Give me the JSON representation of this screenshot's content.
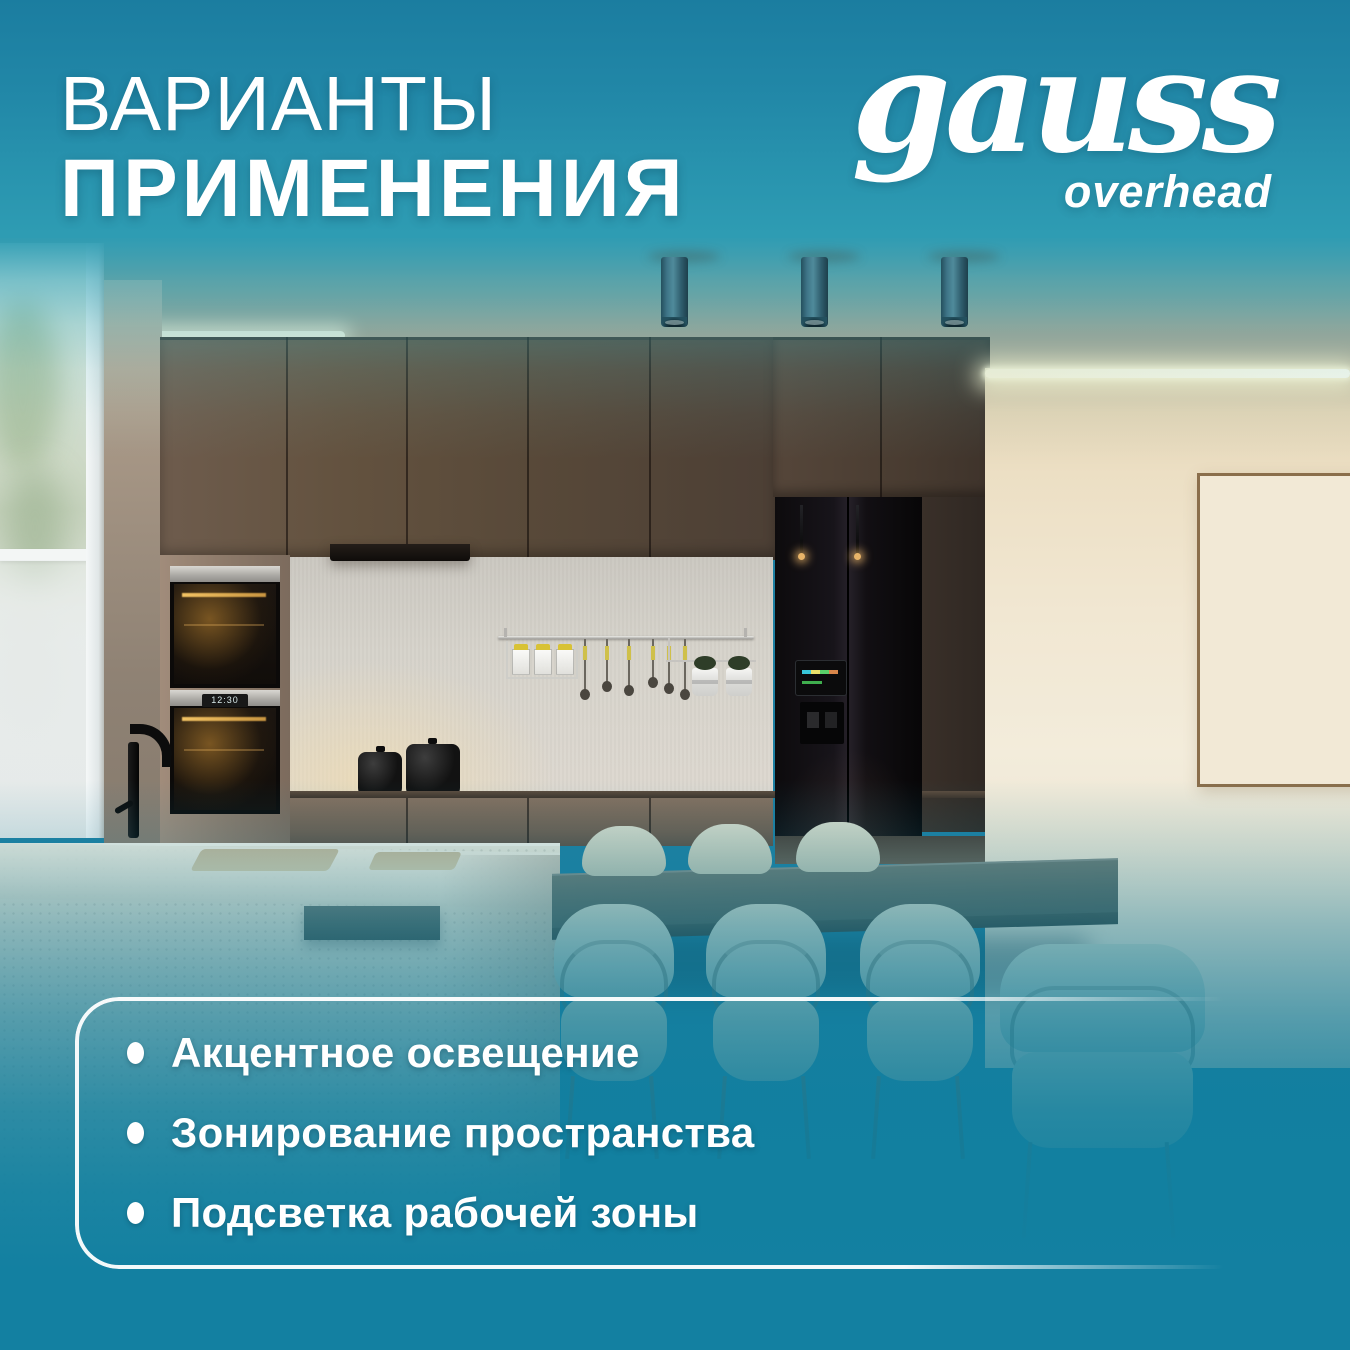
{
  "title": {
    "line1": "ВАРИАНТЫ",
    "line2": "ПРИМЕНЕНИЯ"
  },
  "logo": {
    "brand": "gauss",
    "subtitle": "overhead"
  },
  "features": {
    "items": [
      {
        "label": "Акцентное освещение"
      },
      {
        "label": "Зонирование пространства"
      },
      {
        "label": "Подсветка рабочей зоны"
      }
    ]
  },
  "scene": {
    "oven_display": "12:30"
  },
  "colors": {
    "overlay_top": "#1d7fa2",
    "overlay_bottom": "#1380a1",
    "accent_teal": "#2e9cb3",
    "wall_cream": "#f1e7d2",
    "cabinet_brown": "#5d4d41",
    "text": "#ffffff"
  }
}
